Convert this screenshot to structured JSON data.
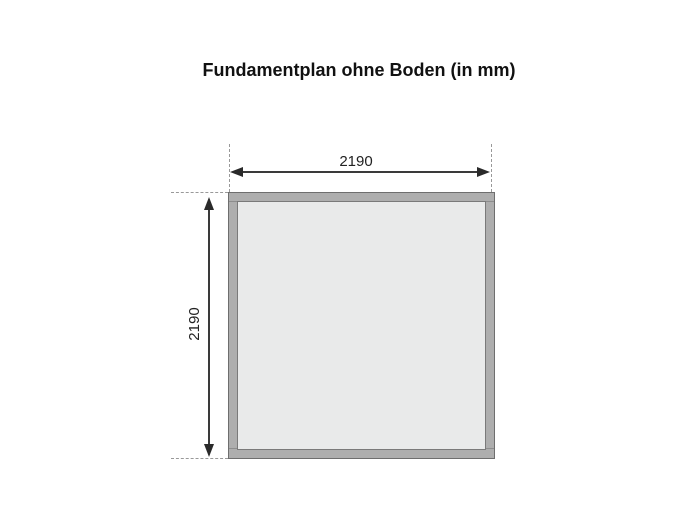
{
  "title": "Fundamentplan ohne Boden (in mm)",
  "diagram": {
    "width_label": "2190",
    "height_label": "2190"
  },
  "colors": {
    "background": "#ffffff",
    "frame_fill": "#aeaeae",
    "frame_outline": "#6e6e6e",
    "interior_fill": "#e9eaea",
    "dimension_line": "#3a3a3a",
    "arrowhead": "#2a2a2a",
    "extension_line": "#999999",
    "title_text": "#111111",
    "label_text": "#222222"
  }
}
